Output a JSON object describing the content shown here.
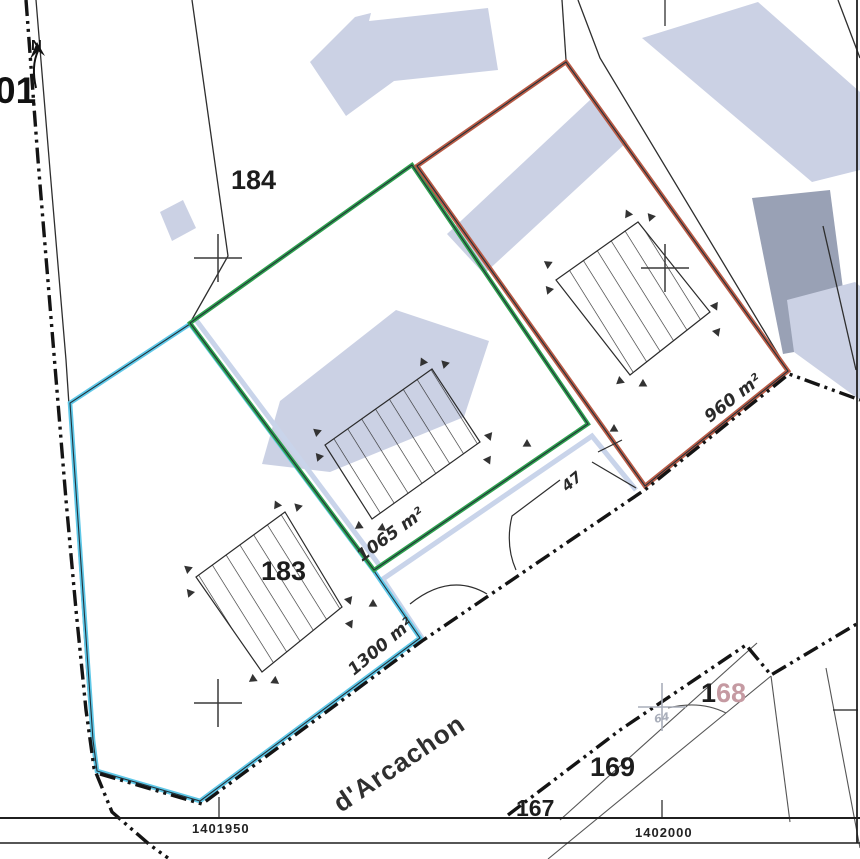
{
  "document": {
    "kind": "cadastral-division-plan"
  },
  "parcels": {
    "p201": {
      "label": "01"
    },
    "p184": {
      "label": "184"
    },
    "p183": {
      "label": "183",
      "area": "1300 m²"
    },
    "lot_green": {
      "area": "1065 m²"
    },
    "lot_red": {
      "area": "960 m²"
    },
    "lot_47": {
      "label": "47"
    },
    "p168": {
      "prefix": "1",
      "suffix": "68"
    },
    "p169": {
      "label": "169"
    },
    "p167": {
      "label": "167"
    }
  },
  "street": {
    "name": "d'Arcachon"
  },
  "grid": {
    "x_left": "1401950",
    "x_right": "1402000"
  },
  "compass": {
    "label": "N"
  },
  "survey": {
    "point_label": "64"
  },
  "icons": {
    "north_arrow": "↑N",
    "survey_cross": "+",
    "triangle_marker": "▲",
    "hatch_building": "▨"
  },
  "colors": {
    "parcel_red": "#b85b46",
    "parcel_green": "#2ea04e",
    "parcel_cyan": "#5fc8e8",
    "access_pale": "#c9d4ea",
    "building_light": "#cbd1e4",
    "building_dark": "#99a1b5",
    "label_pink": "#c59aa2",
    "survey_gray": "#a9aeba",
    "ink": "#222222"
  }
}
